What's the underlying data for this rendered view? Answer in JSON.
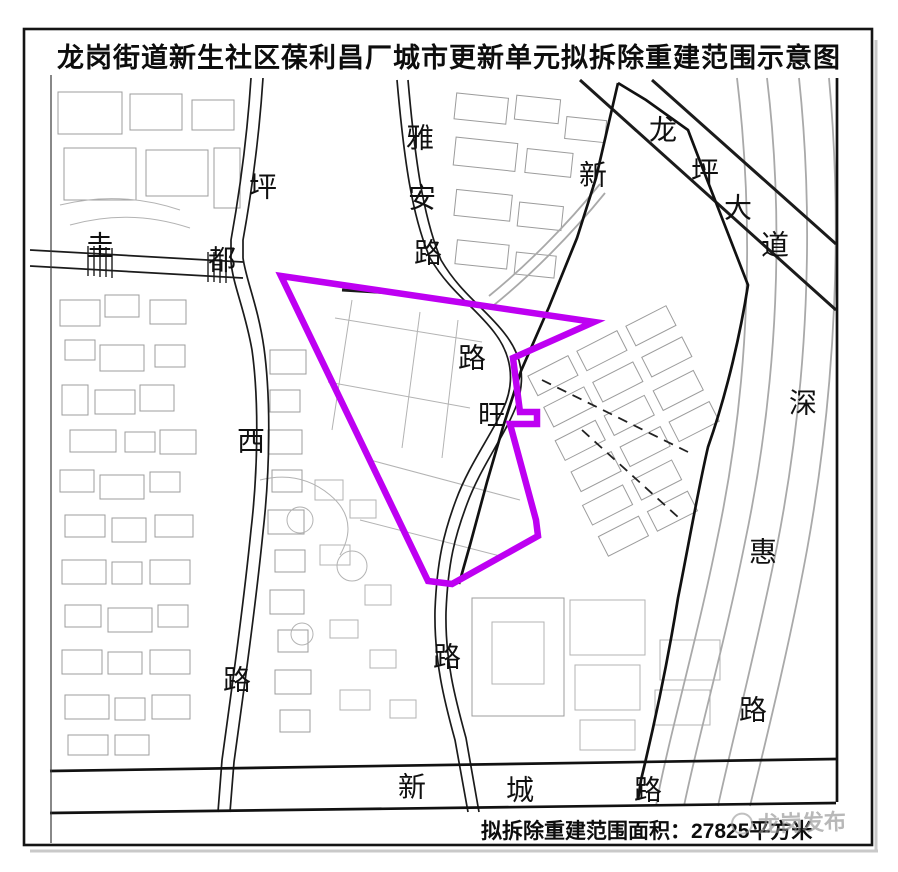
{
  "title": "龙岗街道新生社区葆利昌厂城市更新单元拟拆除重建范围示意图",
  "area_note": {
    "prefix": "拟拆除重建范围面积：",
    "area": "27825平方米"
  },
  "watermark": {
    "text": "龙岗发布"
  },
  "colors": {
    "demolition_boundary": "#BE00F2",
    "unit_boundary": "#111111",
    "road": "#1b1b1b",
    "minor_road": "#a9a9a9",
    "parcel": "#9c9c9c",
    "watermark": "#8e8e8e"
  },
  "demolition_boundary_polygon": [
    [
      281,
      276
    ],
    [
      594,
      322
    ],
    [
      513,
      358
    ],
    [
      520,
      412
    ],
    [
      537,
      412
    ],
    [
      537,
      424
    ],
    [
      510,
      424
    ],
    [
      536,
      520
    ],
    [
      538,
      536
    ],
    [
      452,
      584
    ],
    [
      428,
      581
    ]
  ],
  "road_labels": [
    {
      "text": "坪",
      "x": 263,
      "y": 187,
      "road": "pingxi-road"
    },
    {
      "text": "西",
      "x": 251,
      "y": 441,
      "road": "pingxi-road"
    },
    {
      "text": "路",
      "x": 237,
      "y": 680,
      "road": "pingxi-road"
    },
    {
      "text": "圭",
      "x": 100,
      "y": 246,
      "road": "guidu-road"
    },
    {
      "text": "都",
      "x": 222,
      "y": 260,
      "road": "guidu-road"
    },
    {
      "text": "雅",
      "x": 420,
      "y": 138,
      "road": "yaan-road"
    },
    {
      "text": "安",
      "x": 422,
      "y": 198,
      "road": "yaan-road"
    },
    {
      "text": "路",
      "x": 428,
      "y": 253,
      "road": "yaan-road"
    },
    {
      "text": "新",
      "x": 593,
      "y": 175,
      "road": "xin-road"
    },
    {
      "text": "龙",
      "x": 663,
      "y": 130,
      "road": "longping-avenue"
    },
    {
      "text": "坪",
      "x": 705,
      "y": 172,
      "road": "longping-avenue"
    },
    {
      "text": "大",
      "x": 738,
      "y": 208,
      "road": "longping-avenue"
    },
    {
      "text": "道",
      "x": 775,
      "y": 245,
      "road": "longping-avenue"
    },
    {
      "text": "路",
      "x": 472,
      "y": 358,
      "road": "wang-road"
    },
    {
      "text": "旺",
      "x": 492,
      "y": 415,
      "road": "wang-road"
    },
    {
      "text": "路",
      "x": 447,
      "y": 657,
      "road": "wang-road"
    },
    {
      "text": "深",
      "x": 803,
      "y": 403,
      "road": "shenhui-road"
    },
    {
      "text": "惠",
      "x": 763,
      "y": 552,
      "road": "shenhui-road"
    },
    {
      "text": "路",
      "x": 753,
      "y": 710,
      "road": "shenhui-road"
    },
    {
      "text": "新",
      "x": 412,
      "y": 787,
      "road": "xincheng-road"
    },
    {
      "text": "城",
      "x": 520,
      "y": 790,
      "road": "xincheng-road"
    },
    {
      "text": "路",
      "x": 648,
      "y": 790,
      "road": "xincheng-road"
    }
  ]
}
